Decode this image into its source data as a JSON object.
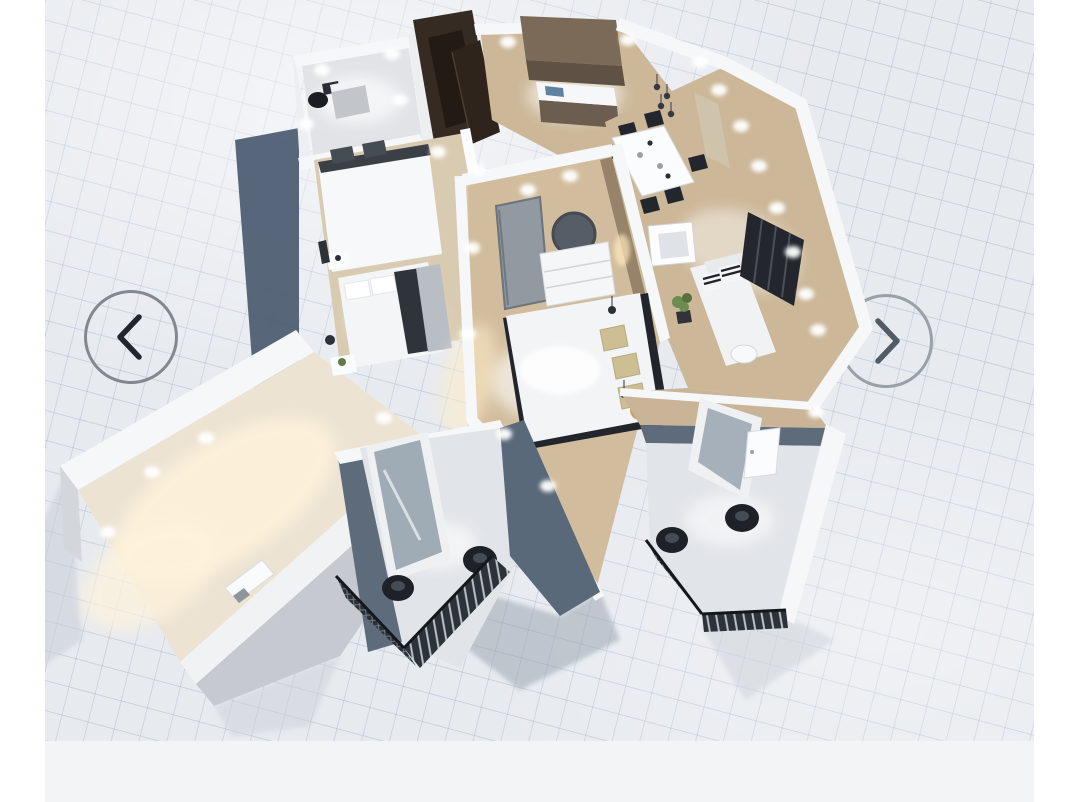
{
  "app": {
    "view": "3d-floorplan-carousel"
  },
  "carousel": {
    "prev_label": "Previous view",
    "next_label": "Next view",
    "prev_icon": "chevron-left",
    "next_icon": "chevron-right"
  },
  "colors": {
    "page_bg": "#ffffff",
    "canvas_bg": "#e7eaef",
    "grid_line": "#9aa8c4",
    "footer_bg": "#f2f4f6",
    "wall_top": "#f6f7f9",
    "wall_side": "#c6cad0",
    "slate_wall": "#5d6b7b",
    "shadow_dark": "#4b5a70",
    "floor_wood": "#ccb798",
    "floor_cream": "#ece3d3",
    "floor_balcony": "#e1e4e8",
    "furniture_dark": "#23272d",
    "cabinet_brown": "#7b6a58",
    "wardrobe_brown": "#352b22",
    "accent_tan": "#c89f63",
    "plant_green": "#6d8c51",
    "nav_ring_left": "#83888f",
    "nav_ring_right": "#9aa0a8",
    "nav_chevron_left": "#22262c",
    "nav_chevron_right": "#525a64"
  },
  "scene": {
    "type": "3d-floorplan-render",
    "rooms": [
      "wc",
      "kitchen",
      "dining-area",
      "living-room",
      "bedroom",
      "master-bedroom",
      "sunroom",
      "balcony-center",
      "balcony-right"
    ],
    "objects": [
      "toilet",
      "dark-wardrobe-door",
      "kitchen-cabinets",
      "kitchen-counter",
      "dining-table",
      "dining-chairs",
      "pendant-lamps",
      "picture-frame",
      "sofa",
      "striped-pillows",
      "window-panels",
      "plant",
      "interior-door",
      "round-mirror",
      "dresser",
      "double-bed",
      "bed-pillows",
      "side-table",
      "murphy-bed",
      "single-bed",
      "nightstands",
      "radiator",
      "glass-doors",
      "balcony-lounge-chairs",
      "balcony-railings",
      "ceiling-spotlights",
      "ground-shadow"
    ]
  }
}
